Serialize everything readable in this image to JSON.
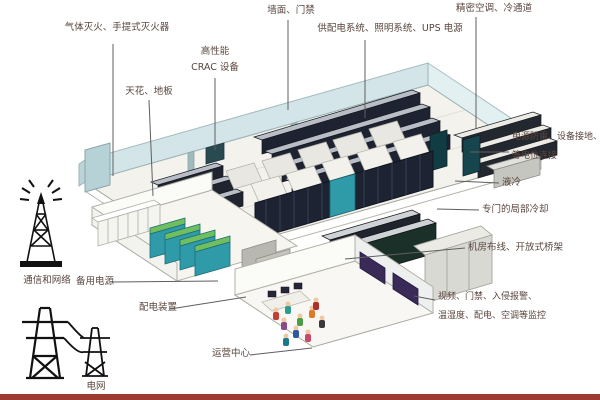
{
  "labels": {
    "fire": "气体灭火、手提式灭火器",
    "crac_1": "高性能",
    "crac_2": "CRAC 设备",
    "ceiling_floor": "天花、地板",
    "wall_door": "墙面、门禁",
    "power_supply": "供配电系统、照明系统、UPS 电源",
    "hvac": "精密空调、冷通道",
    "lightning_1": "电源防雷、设备接地、",
    "lightning_2": "等电位连接",
    "liquid_cooling": "液冷",
    "local_cooling": "专门的局部冷却",
    "cabling": "机房布线、开放式桥架",
    "monitoring_1": "视频、门禁、入侵报警、",
    "monitoring_2": "温湿度、配电、空调等监控",
    "comm_network": "通信和网络",
    "power_grid": "电网",
    "backup_power": "备用电源",
    "power_distribution": "配电装置",
    "operation_center": "运营中心"
  },
  "icons": {
    "comm_tower": "radio-tower-icon",
    "grid": "transmission-pylon-icon"
  },
  "colors": {
    "rack_dark": "#1d2330",
    "wall_glass": "#cfe3e6",
    "generator_teal": "#2f9aa8",
    "generator_green": "#6fbf5e",
    "monitor_purple": "#3a2a58",
    "label_text": "#5a453e",
    "bottom_strip": "#9c3c30"
  }
}
